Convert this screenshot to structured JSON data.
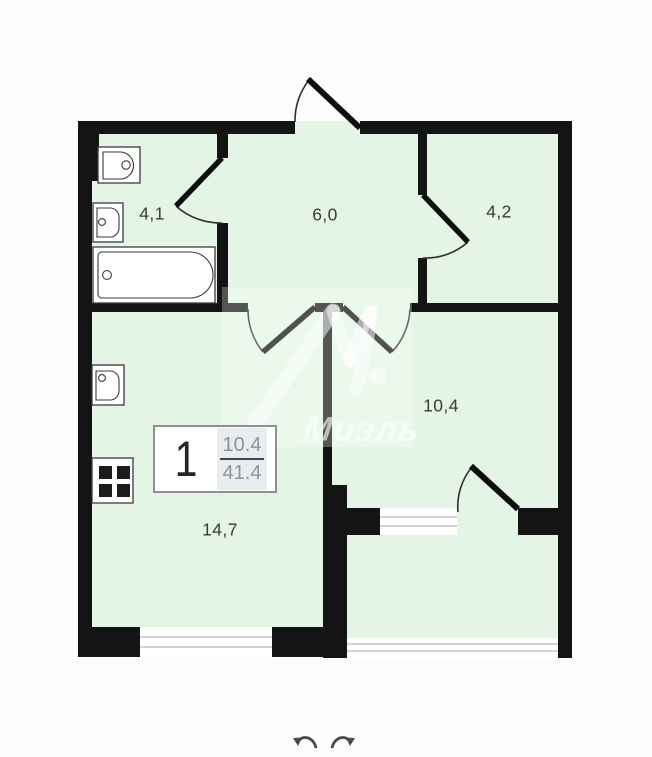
{
  "floor_plan": {
    "watermark_text": "Миэль",
    "rooms": [
      {
        "id": "bathroom",
        "area": "4,1"
      },
      {
        "id": "hallway",
        "area": "6,0"
      },
      {
        "id": "storage-room",
        "area": "4,2"
      },
      {
        "id": "bedroom",
        "area": "10,4"
      },
      {
        "id": "kitchen-living",
        "area": "14,7"
      }
    ],
    "info_box": {
      "room_count": "1",
      "living_area": "10.4",
      "total_area": "41.4"
    },
    "fixtures": [
      "toilet-icon",
      "washbasin-icon",
      "bathtub-icon",
      "kitchen-sink-icon",
      "stove-icon"
    ],
    "colors": {
      "room_fill": "#e4f5e5",
      "wall": "#141414",
      "background": "#fcfcfc",
      "door_arc": "#2f2f2f",
      "window_line": "#c0c6c2",
      "fraction_panel": "#e7ecef",
      "watermark": "#ffffff"
    }
  },
  "controls": {
    "undo_icon": "undo-arrow",
    "redo_icon": "redo-arrow"
  }
}
